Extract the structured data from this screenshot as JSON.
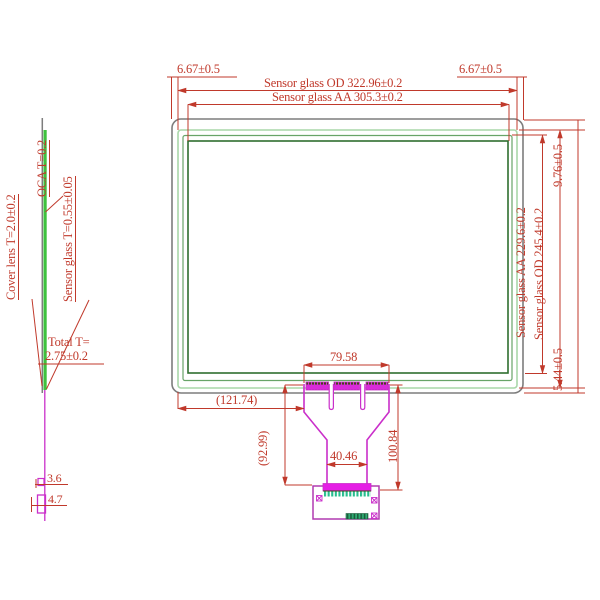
{
  "drawing": {
    "type": "touch-panel sensor glass engineering drawing",
    "colors": {
      "dimension_red": "#c0392b",
      "cover_lens_gray": "#7d7d7d",
      "sensor_od_green_light": "#a9d7a9",
      "mid_green": "#68a468",
      "aa_green_dark": "#2f6e2f",
      "side_glass_green": "#3ec23e",
      "fpc_magenta": "#ca2fca",
      "fpc_fill_magenta": "#e51ee5",
      "connector_teal": "#26bd8e"
    },
    "side_view": {
      "label_cover_lens": "Cover lens T=2.0±0.2",
      "label_oca": "OCA T=0.2",
      "label_sensor_glass": "Sensor glass T=0.55±0.05",
      "label_total_line1": "Total T=",
      "label_total_line2": "2.75±0.2",
      "dim_3_6": "3.6",
      "dim_4_7": "4.7"
    },
    "front_view": {
      "dim_offset_top_left": "6.67±0.5",
      "dim_offset_top_right": "6.67±0.5",
      "dim_od_width": "Sensor glass OD 322.96±0.2",
      "dim_aa_width": "Sensor glass AA 305.3±0.2",
      "dim_offset_top_edge": "9.76±0.5",
      "dim_aa_height": "Sensor glass AA 229.6±0.2",
      "dim_od_height": "Sensor glass OD 245.4±0.2",
      "dim_offset_bottom_edge": "5.44±0.5"
    },
    "fpc_tail": {
      "dim_bond_width": "79.58",
      "dim_offset_x": "(121.74)",
      "dim_tail_length": "(92.99)",
      "dim_neck_width": "40.46",
      "dim_total_length": "100.84"
    }
  }
}
